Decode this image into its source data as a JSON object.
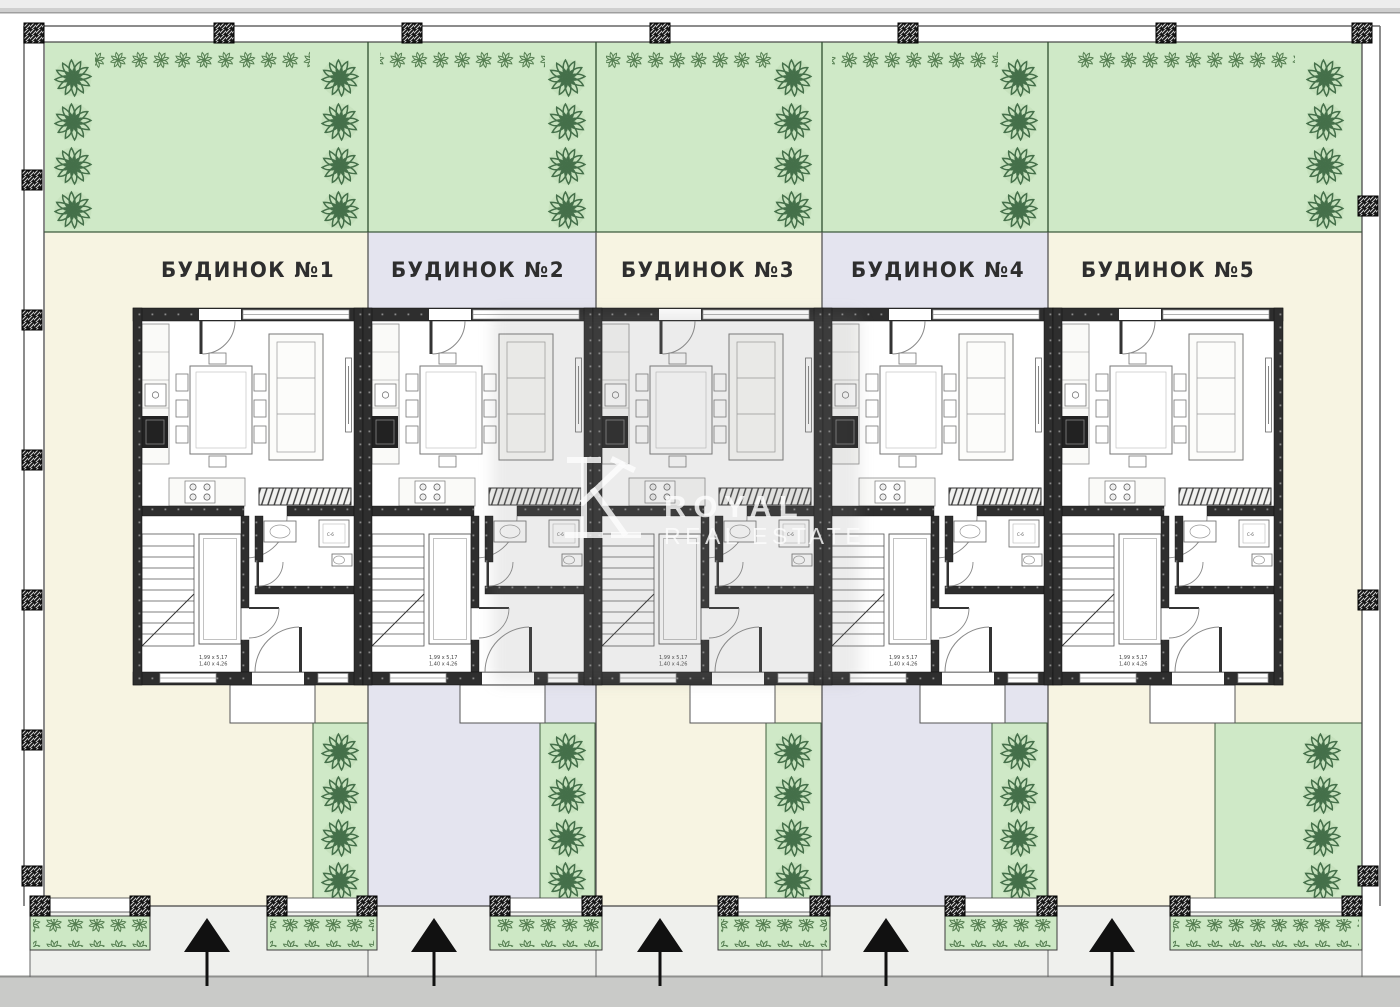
{
  "houses": [
    {
      "label": "БУДИНОК №1"
    },
    {
      "label": "БУДИНОК №2"
    },
    {
      "label": "БУДИНОК №3"
    },
    {
      "label": "БУДИНОК №4"
    },
    {
      "label": "БУДИНОК №5"
    }
  ],
  "watermark": {
    "brand_top": "ROYAL",
    "brand_bottom": "REAL ESTATE",
    "logo": "royal-real-estate-monogram"
  },
  "floorplan": {
    "stair_dim_line1": "1,99 x 5,17",
    "stair_dim_line2": "1,40 x 4,26",
    "boiler_label": "С-6"
  },
  "colors": {
    "garden_green": "#cfe9c7",
    "hedge_green": "#cde8c5",
    "plot_cream": "#f7f4e2",
    "plot_lavender": "#e4e4ef",
    "wall_dark": "#2e2e2e",
    "road_gray": "#c9cac8",
    "sidewalk_gray": "#eff0ed",
    "tree_green": "#4a7747",
    "arrow_black": "#111111",
    "watermark_white": "rgba(252,252,252,0.82)"
  }
}
